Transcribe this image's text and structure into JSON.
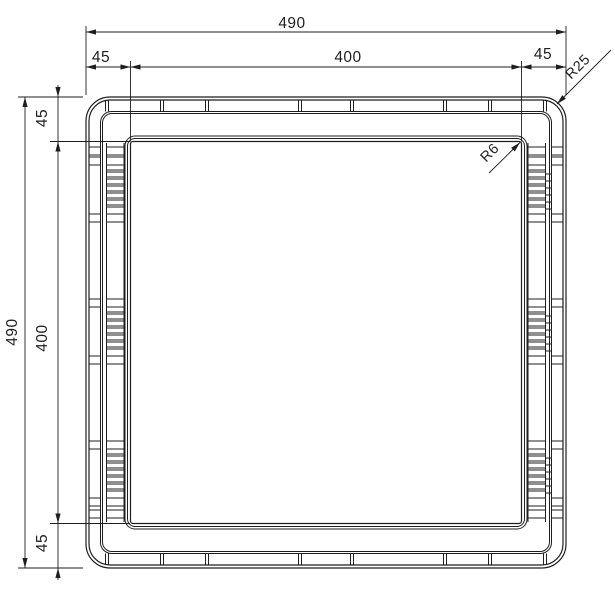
{
  "drawing": {
    "type": "technical-drawing",
    "subject": "square frame plan view",
    "dimensions": {
      "top_overall": "490",
      "top_inset_left": "45",
      "top_opening": "400",
      "top_inset_right": "45",
      "side_overall": "490",
      "side_inset_top": "45",
      "side_opening": "400",
      "side_inset_bottom": "45",
      "radius_outer": "R25",
      "radius_inner": "R6"
    },
    "colors": {
      "line": "#1f1f1f",
      "background": "#ffffff"
    }
  }
}
